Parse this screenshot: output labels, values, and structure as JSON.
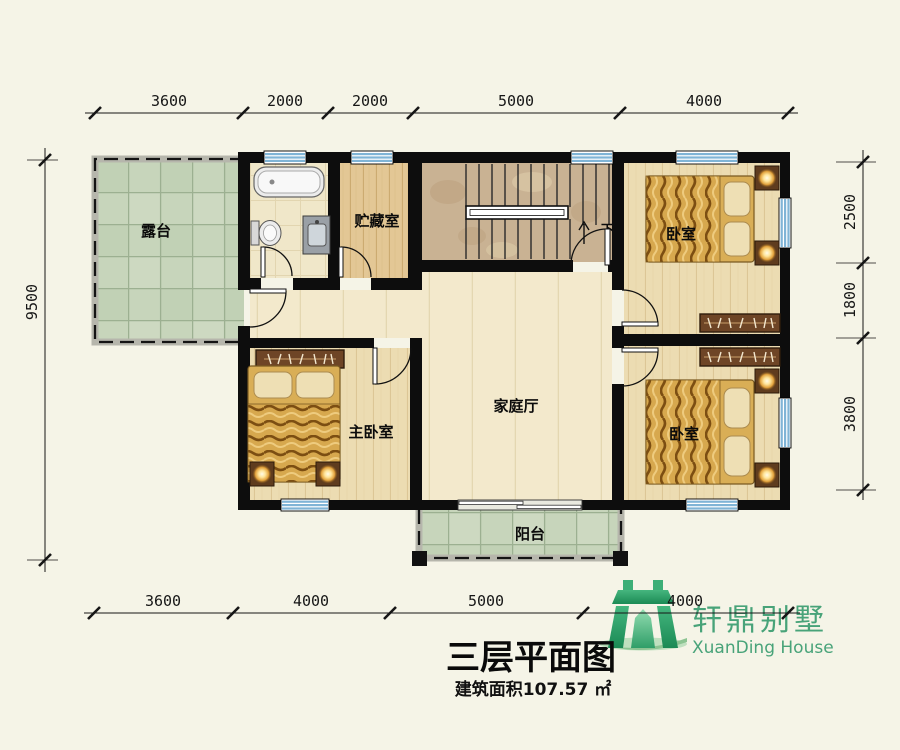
{
  "plan": {
    "title": "三层平面图",
    "area": "建筑面积107.57 ㎡",
    "rooms": {
      "terrace": "露台",
      "storage": "贮藏室",
      "bedroom_ne": "卧室",
      "master_bedroom": "主卧室",
      "family_hall": "家庭厅",
      "bedroom_se": "卧室",
      "balcony": "阳台",
      "stair_down": "下"
    },
    "dims": {
      "top": [
        "3600",
        "2000",
        "2000",
        "5000",
        "4000"
      ],
      "bottom": [
        "3600",
        "4000",
        "5000",
        "4000"
      ],
      "left": "9500",
      "right": [
        "2500",
        "1800",
        "3800"
      ]
    }
  },
  "logo": {
    "cn": "轩鼎别墅",
    "en": "XuanDing House"
  },
  "colors": {
    "background": "#f5f4e7",
    "wall": "#0d0d0d",
    "window_blue": "#7fb4d6",
    "tile_green": "#c7d5bb",
    "wood_floor": "#ebd9ad",
    "marble": "#c9b293",
    "bed_gold": "#d7a84e",
    "logo_green": "#48a379"
  }
}
